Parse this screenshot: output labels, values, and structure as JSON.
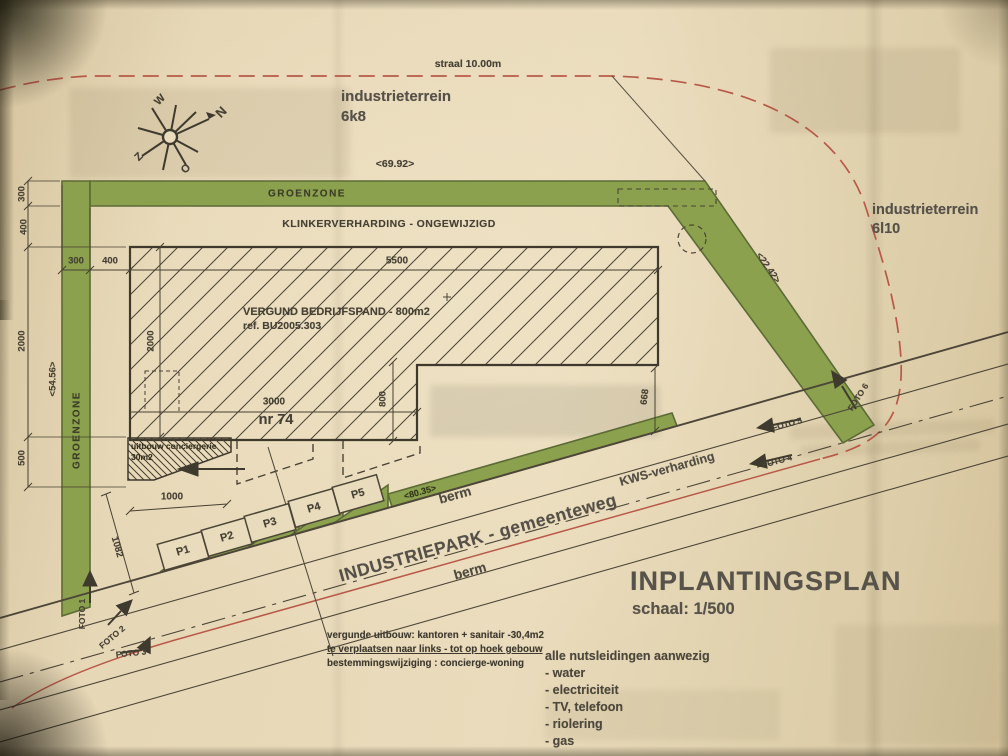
{
  "meta": {
    "title": "INPLANTINGSPLAN",
    "scale": "schaal: 1/500"
  },
  "colors": {
    "paper": "#e6d7b6",
    "green": "#8ba14d",
    "green_edge": "#5c6b36",
    "red": "#b85948",
    "ink": "#464135"
  },
  "areas": {
    "street_note": "straal 10.00m",
    "parcel_nw_name": "industrieterrein",
    "parcel_nw_code": "6k8",
    "parcel_e_name": "industrieterrein",
    "parcel_e_code": "6l10",
    "green_top": "GROENZONE",
    "green_left": "GROENZONE",
    "paving": "KLINKERVERHARDING - ONGEWIJZIGD",
    "road_name": "INDUSTRIEPARK - gemeenteweg",
    "road_surface": "KWS-verharding",
    "verge_north": "berm",
    "verge_south": "berm"
  },
  "building": {
    "label": "VERGUND BEDRIJFSPAND - 800m2",
    "ref": "ref. BU2005.303",
    "house_no": "nr 74",
    "annex_line1": "uitbouw conciergerie",
    "annex_line2": "30m2"
  },
  "compass": {
    "n": "N",
    "e": "O",
    "s": "Z",
    "w": "W"
  },
  "parking": [
    "P1",
    "P2",
    "P3",
    "P4",
    "P5"
  ],
  "photos": [
    "FOTO 1",
    "FOTO 2",
    "FOTO 3",
    "FOTO 4",
    "FOTO 5",
    "FOTO 6"
  ],
  "dims": {
    "d69": "<69.92>",
    "d54": "<54.56>",
    "d22": "<22.42>",
    "d80": "<80.35>",
    "d300v": "300",
    "d400v": "400",
    "d2000v": "2000",
    "d500v": "500",
    "d300h": "300",
    "d400h": "400",
    "d5500": "5500",
    "d2000i": "2000",
    "d3000": "3000",
    "d800": "800",
    "d668": "668",
    "d1000": "1000",
    "d1082": "1082"
  },
  "notes": {
    "l1": "vergunde uitbouw: kantoren + sanitair -30,4m2",
    "l2": "te verplaatsen naar links - tot op hoek gebouw",
    "l3": "bestemmingswijziging : concierge-woning"
  },
  "utilities": [
    "alle nutsleidingen aanwezig",
    "- water",
    "- electriciteit",
    "- TV, telefoon",
    "- riolering",
    "- gas"
  ]
}
